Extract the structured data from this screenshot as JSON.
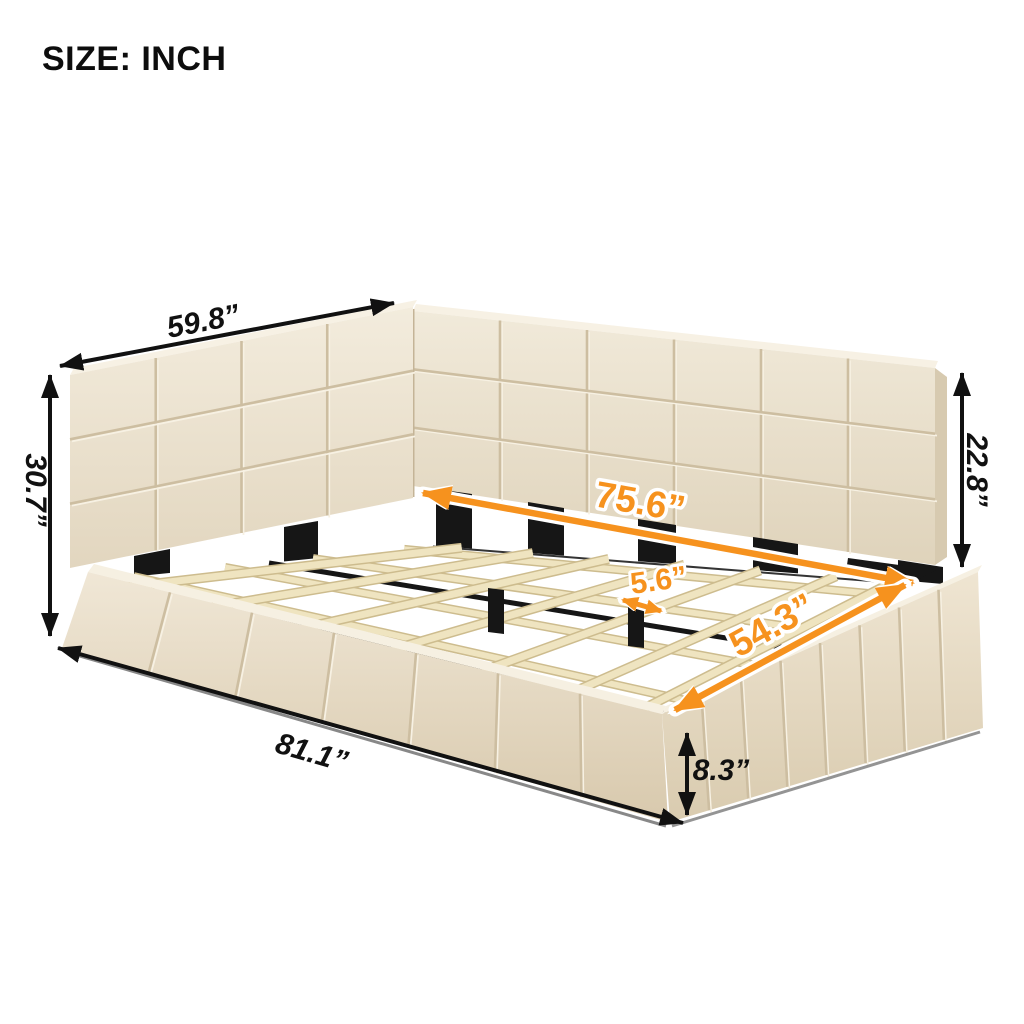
{
  "title": "SIZE: INCH",
  "figure": {
    "description": "Beige upholstered platform bed with L-shaped square-tufted backrest and wood slat support",
    "unit": "inch"
  },
  "colors": {
    "accent_orange": "#F6921E",
    "dimension_black": "#111111",
    "fabric_beige": "#EDE4D1",
    "slat_wood": "#EFE4C0",
    "support_black": "#161616",
    "background": "#FFFFFF"
  },
  "dimensions": {
    "headboard_width": {
      "label": "59.8”"
    },
    "overall_height": {
      "label": "30.7”"
    },
    "interior_length": {
      "label": "75.6”"
    },
    "slat_spacing": {
      "label": "5.6”"
    },
    "backrest_height": {
      "label": "22.8”"
    },
    "interior_width": {
      "label": "54.3”"
    },
    "overall_length": {
      "label": "81.1”"
    },
    "base_height": {
      "label": "8.3”"
    }
  }
}
